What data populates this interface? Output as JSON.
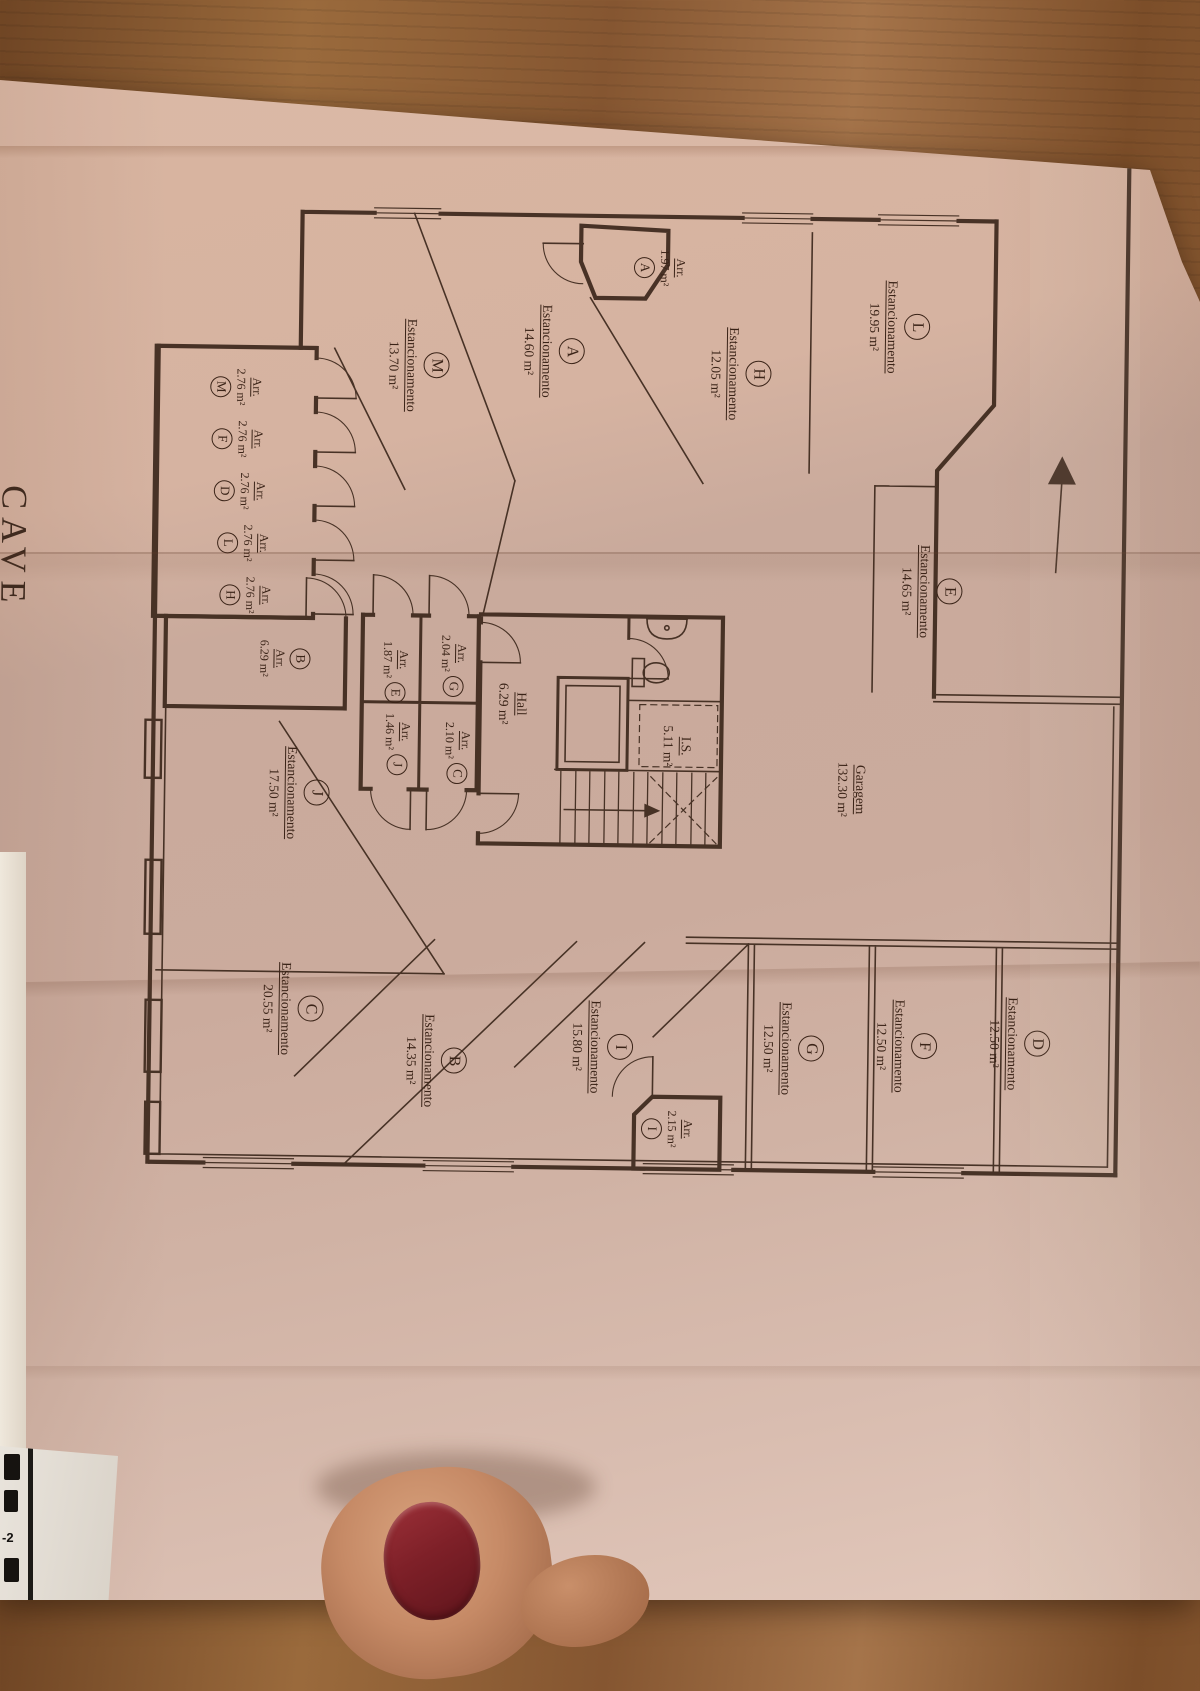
{
  "document": {
    "title": "CAVE",
    "underlay_fragment": "-2"
  },
  "plan": {
    "parking_word": "Estancionamento",
    "storage_word": "Arr.",
    "parkings": [
      {
        "id": "L",
        "area": "19.95 m²"
      },
      {
        "id": "H",
        "area": "12.05 m²"
      },
      {
        "id": "A",
        "area": "14.60 m²"
      },
      {
        "id": "M",
        "area": "13.70 m²"
      },
      {
        "id": "E",
        "area": "14.65 m²"
      },
      {
        "id": "J",
        "area": "17.50 m²"
      },
      {
        "id": "C",
        "area": "20.55 m²"
      },
      {
        "id": "B",
        "area": "14.35 m²"
      },
      {
        "id": "I",
        "area": "15.80 m²"
      },
      {
        "id": "G",
        "area": "12.50 m²"
      },
      {
        "id": "F",
        "area": "12.50 m²"
      },
      {
        "id": "D",
        "area": "12.50 m²"
      }
    ],
    "storages": [
      {
        "id": "A",
        "area": "1.97 m²"
      },
      {
        "id": "M",
        "area": "2.76 m²"
      },
      {
        "id": "F",
        "area": "2.76 m²"
      },
      {
        "id": "D",
        "area": "2.76 m²"
      },
      {
        "id": "L",
        "area": "2.76 m²"
      },
      {
        "id": "H",
        "area": "2.76 m²"
      },
      {
        "id": "B",
        "area": "6.29 m²"
      },
      {
        "id": "E",
        "area": "1.87 m²"
      },
      {
        "id": "G",
        "area": "2.04 m²"
      },
      {
        "id": "J",
        "area": "1.46 m²"
      },
      {
        "id": "C",
        "area": "2.10 m²"
      },
      {
        "id": "I",
        "area": "2.15 m²"
      }
    ],
    "rooms": [
      {
        "name": "Garagem",
        "area": "132.30 m²"
      },
      {
        "name": "Hall",
        "area": "6.29 m²"
      },
      {
        "name": "I.S.",
        "area": "5.11 m²"
      }
    ]
  },
  "colors": {
    "ink": "#3c281c",
    "paper": "#d2b1a1",
    "nail": "#7e2028",
    "wood": "#8a5a31"
  }
}
